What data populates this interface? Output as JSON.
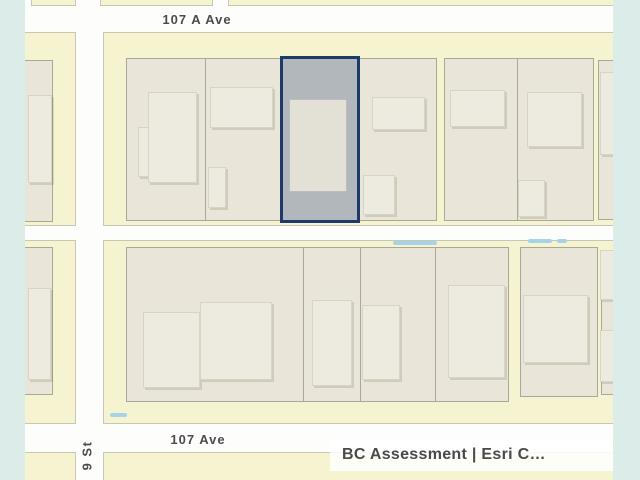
{
  "map": {
    "street_labels": {
      "top": "107 A Ave",
      "bottom": "107 Ave",
      "left": "9 St"
    },
    "highlighted_parcel": {
      "label": "12944",
      "outline_color": "#1e3a68",
      "fill_color": "rgba(32,62,112,0.28)",
      "label_color": "#27598a"
    },
    "attribution": {
      "text": "BC Assessment | Esri C…"
    },
    "colors": {
      "page_margin": "#dcede9",
      "street": "#fdfdfc",
      "block": "#f6f3d1",
      "parcel": "#e9e6d9",
      "building": "#edebdf",
      "water_dash": "#a7d3e9",
      "street_label": "#4b4b4b"
    }
  }
}
